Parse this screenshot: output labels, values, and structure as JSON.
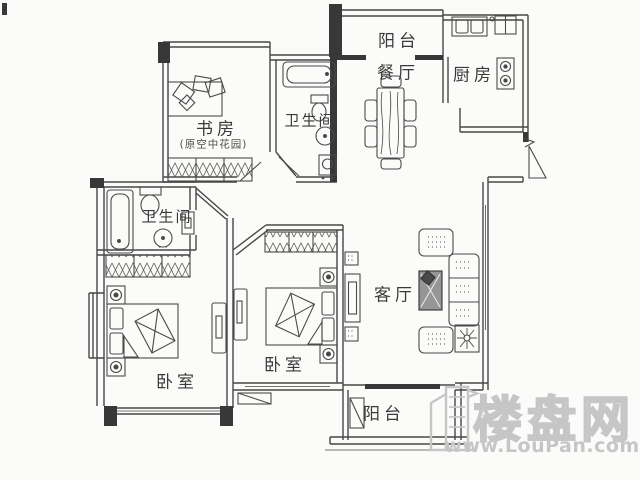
{
  "page": {
    "background": "#fbfbf9",
    "line_color": "#474747",
    "watermark_color": "#c6c6c6"
  },
  "rooms": {
    "balcony_top": {
      "label": "阳台"
    },
    "dining": {
      "label": "餐厅"
    },
    "kitchen": {
      "label": "厨房"
    },
    "bath_top": {
      "label": "卫生间"
    },
    "study": {
      "label": "书房",
      "note": "(原空中花园)"
    },
    "bath_left": {
      "label": "卫生间"
    },
    "bedroom_left": {
      "label": "卧室"
    },
    "bedroom_mid": {
      "label": "卧室"
    },
    "living": {
      "label": "客厅"
    },
    "balcony_bottom": {
      "label": "阳台"
    }
  },
  "watermark": {
    "brand": "楼盘网",
    "url": "www.LouPan.com"
  }
}
